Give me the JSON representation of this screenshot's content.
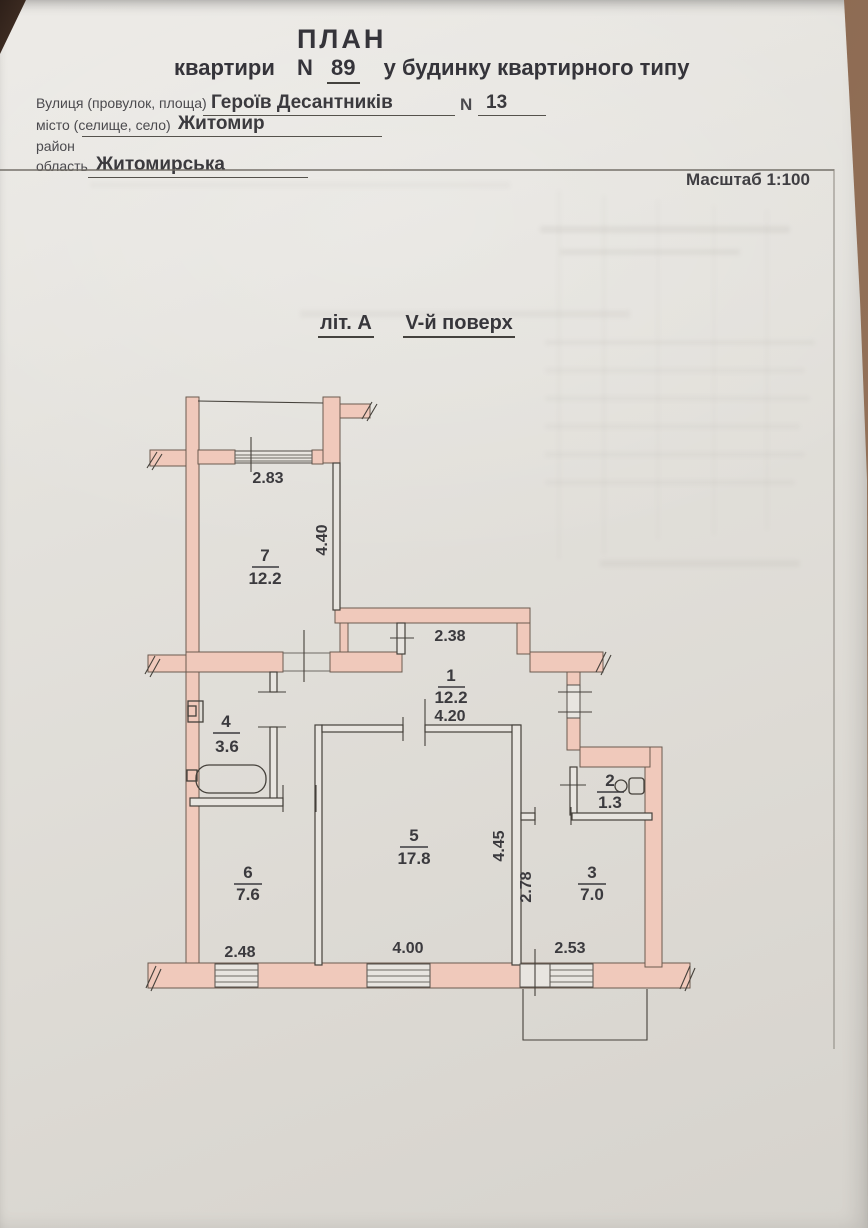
{
  "document": {
    "title": "ПЛАН",
    "subtitle": {
      "prefix": "квартири",
      "number_label": "N",
      "apartment_number": "89",
      "suffix": "у будинку квартирного типу"
    },
    "fields": {
      "street_label": "Вулиця (провулок, площа)",
      "street_value": "Героїв Десантників",
      "house_number_label": "N",
      "house_number_value": "13",
      "city_label": "місто (селище, село)",
      "city_value": "Житомир",
      "district_label": "район",
      "district_value": "",
      "region_label": "область",
      "region_value": "Житомирська"
    },
    "scale_label": "Масштаб 1:100"
  },
  "plan": {
    "caption": {
      "liter": "літ. А",
      "floor": "V-й поверх"
    },
    "rooms": {
      "room1": {
        "number": "1",
        "area": "12.2"
      },
      "room2": {
        "number": "2",
        "area": "1.3"
      },
      "room3": {
        "number": "3",
        "area": "7.0"
      },
      "room4": {
        "number": "4",
        "area": "3.6"
      },
      "room5": {
        "number": "5",
        "area": "17.8"
      },
      "room6": {
        "number": "6",
        "area": "7.6"
      },
      "room7": {
        "number": "7",
        "area": "12.2"
      }
    },
    "dimensions": {
      "balcony_window_width": "2.83",
      "room7_depth": "4.40",
      "hall_width": "2.38",
      "hall_length": "4.20",
      "room5_depth": "4.45",
      "room3_depth": "2.78",
      "room6_width": "2.48",
      "room5_width": "4.00",
      "room3_width": "2.53"
    },
    "colors": {
      "wall_fill": "#f0c9bb",
      "drafting_line": "#45413b",
      "text": "#3b3a3e"
    }
  }
}
